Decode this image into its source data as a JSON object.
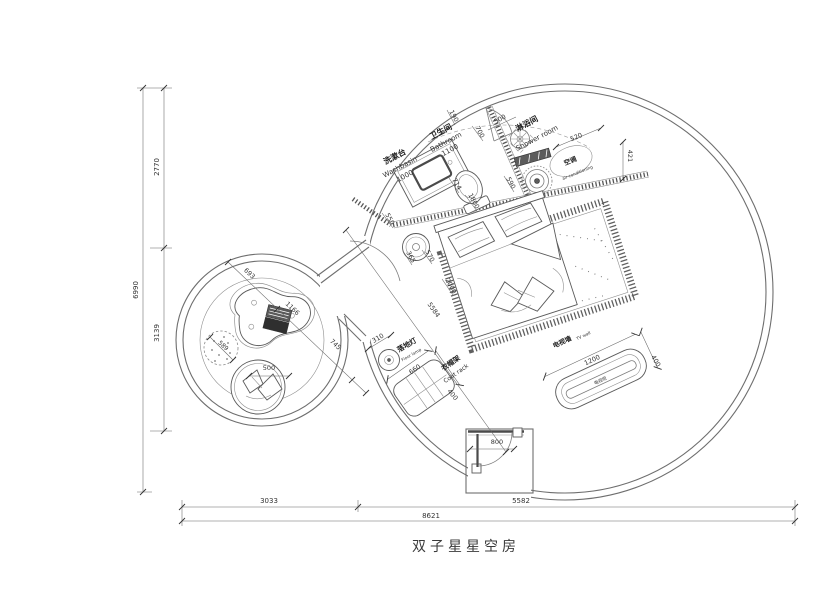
{
  "drawing": {
    "title": "双子星星空房",
    "annotations": [
      {
        "t": "洗漱台",
        "x": 396,
        "y": 159,
        "r": -28,
        "s": 8,
        "k": "room"
      },
      {
        "t": "Washbasin",
        "x": 401,
        "y": 169,
        "r": -28,
        "s": 7,
        "k": "sub"
      },
      {
        "t": "1000",
        "x": 406,
        "y": 178,
        "r": -28,
        "s": 7,
        "k": "dim"
      },
      {
        "t": "卫生间",
        "x": 442,
        "y": 134,
        "r": -28,
        "s": 8,
        "k": "room"
      },
      {
        "t": "Bathroom",
        "x": 447,
        "y": 144,
        "r": -28,
        "s": 7,
        "k": "sub"
      },
      {
        "t": "1100",
        "x": 451,
        "y": 152,
        "r": -28,
        "s": 7,
        "k": "dim"
      },
      {
        "t": "淋浴间",
        "x": 528,
        "y": 126,
        "r": -28,
        "s": 8,
        "k": "room"
      },
      {
        "t": "Shower room",
        "x": 538,
        "y": 140,
        "r": -28,
        "s": 7,
        "k": "sub"
      },
      {
        "t": "空调",
        "x": 571,
        "y": 163,
        "r": -22,
        "s": 6.5,
        "k": "room"
      },
      {
        "t": "air-conditioning",
        "x": 578,
        "y": 174,
        "r": -22,
        "s": 4.2,
        "k": "sub"
      },
      {
        "t": "190",
        "x": 452,
        "y": 117,
        "r": 62,
        "s": 6.5,
        "k": "dim"
      },
      {
        "t": "700",
        "x": 478,
        "y": 133,
        "r": 62,
        "s": 6.5,
        "k": "dim"
      },
      {
        "t": "500",
        "x": 501,
        "y": 121,
        "r": -28,
        "s": 6.5,
        "k": "dim"
      },
      {
        "t": "590",
        "x": 509,
        "y": 184,
        "r": 62,
        "s": 6.5,
        "k": "dim"
      },
      {
        "t": "714",
        "x": 455,
        "y": 185,
        "r": 62,
        "s": 6.5,
        "k": "dim"
      },
      {
        "t": "1800",
        "x": 472,
        "y": 202,
        "r": 62,
        "s": 6.5,
        "k": "dim"
      },
      {
        "t": "550",
        "x": 388,
        "y": 220,
        "r": 62,
        "s": 6.5,
        "k": "dim"
      },
      {
        "t": "365",
        "x": 409,
        "y": 258,
        "r": 62,
        "s": 6.5,
        "k": "dim"
      },
      {
        "t": "570",
        "x": 428,
        "y": 257,
        "r": 62,
        "s": 6.5,
        "k": "dim"
      },
      {
        "t": "2000",
        "x": 449,
        "y": 287,
        "r": 62,
        "s": 6.5,
        "k": "dim"
      },
      {
        "t": "5584",
        "x": 432,
        "y": 311,
        "r": 55,
        "s": 6.5,
        "k": "dim"
      },
      {
        "t": "520",
        "x": 577,
        "y": 139,
        "r": -22,
        "s": 6.5,
        "k": "dim"
      },
      {
        "t": "421",
        "x": 628,
        "y": 156,
        "r": 90,
        "s": 6.5,
        "k": "dim"
      },
      {
        "t": "310",
        "x": 379,
        "y": 340,
        "r": -30,
        "s": 6.5,
        "k": "dim"
      },
      {
        "t": "落地灯",
        "x": 408,
        "y": 347,
        "r": -30,
        "s": 7,
        "k": "room"
      },
      {
        "t": "Floor lamp",
        "x": 412,
        "y": 356,
        "r": -30,
        "s": 4.2,
        "k": "sub"
      },
      {
        "t": "660",
        "x": 416,
        "y": 371,
        "r": -35,
        "s": 6.5,
        "k": "dim"
      },
      {
        "t": "衣帽架",
        "x": 452,
        "y": 365,
        "r": -35,
        "s": 7,
        "k": "room"
      },
      {
        "t": "Coat rack",
        "x": 457,
        "y": 375,
        "r": -35,
        "s": 6,
        "k": "sub"
      },
      {
        "t": "400",
        "x": 451,
        "y": 396,
        "r": 50,
        "s": 6.5,
        "k": "dim"
      },
      {
        "t": "电视墙",
        "x": 563,
        "y": 344,
        "r": -25,
        "s": 6.5,
        "k": "room"
      },
      {
        "t": "TV wall",
        "x": 584,
        "y": 337,
        "r": -25,
        "s": 4.2,
        "k": "sub"
      },
      {
        "t": "1200",
        "x": 593,
        "y": 362,
        "r": -25,
        "s": 6.5,
        "k": "dim"
      },
      {
        "t": "400",
        "x": 654,
        "y": 362,
        "r": 60,
        "s": 6.5,
        "k": "dim"
      },
      {
        "t": "电视柜",
        "x": 601,
        "y": 382,
        "r": -25,
        "s": 4.5,
        "k": "furn"
      },
      {
        "t": "800",
        "x": 497,
        "y": 444,
        "r": 0,
        "s": 6.5,
        "k": "dim"
      },
      {
        "t": "693",
        "x": 248,
        "y": 275,
        "r": 43,
        "s": 6.5,
        "k": "dim"
      },
      {
        "t": "1166",
        "x": 291,
        "y": 310,
        "r": 43,
        "s": 6.5,
        "k": "dim"
      },
      {
        "t": "745",
        "x": 334,
        "y": 346,
        "r": 43,
        "s": 6.5,
        "k": "dim"
      },
      {
        "t": "589",
        "x": 222,
        "y": 347,
        "r": 43,
        "s": 6,
        "k": "dim"
      },
      {
        "t": "500",
        "x": 269,
        "y": 370,
        "r": 0,
        "s": 6.5,
        "k": "dim"
      },
      {
        "t": "2770",
        "x": 159,
        "y": 167,
        "r": -90,
        "s": 7,
        "k": "dim"
      },
      {
        "t": "3139",
        "x": 159,
        "y": 333,
        "r": -90,
        "s": 7,
        "k": "dim"
      },
      {
        "t": "6990",
        "x": 138,
        "y": 290,
        "r": -90,
        "s": 7,
        "k": "dim"
      },
      {
        "t": "3033",
        "x": 269,
        "y": 503,
        "r": 0,
        "s": 7,
        "k": "dim"
      },
      {
        "t": "5582",
        "x": 521,
        "y": 503,
        "r": 0,
        "s": 7,
        "k": "dim"
      },
      {
        "t": "8621",
        "x": 431,
        "y": 518,
        "r": 0,
        "s": 7,
        "k": "dim"
      }
    ]
  }
}
